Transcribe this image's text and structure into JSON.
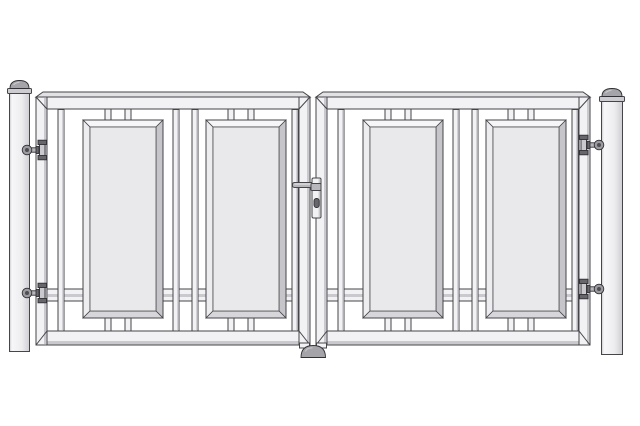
{
  "illustration": {
    "subject": "double swing gate with hinge posts",
    "counts": {
      "posts": 2,
      "gate_leaves": 2,
      "decorative_panels": 4,
      "hinges": 4,
      "locks": 1,
      "ground_stops": 1
    }
  },
  "palette": {
    "background": "#ffffff",
    "line": "#45454a",
    "line_dark": "#303035",
    "face": "#f2f2f4",
    "face_top": "#e2e2e5",
    "shade": "#c9c9ce",
    "panel_fill": "#e9e9eb",
    "bevel_top": "#f6f6f8",
    "bevel_left": "#ededf0",
    "bevel_right": "#c5c5ca",
    "bevel_bottom": "#d7d7db",
    "post_light": "#f7f7f9",
    "post_mid": "#ededef",
    "post_dark": "#cfcfd4",
    "cap": "#a4a4a9",
    "cap_highlight": "#c9c9ce",
    "collar": "#cdcdd1",
    "metal": "#b8b8bc",
    "metal_dark": "#66666b",
    "hinge_disc": "#9b9ba0",
    "hinge_pin": "#4e4e53"
  }
}
